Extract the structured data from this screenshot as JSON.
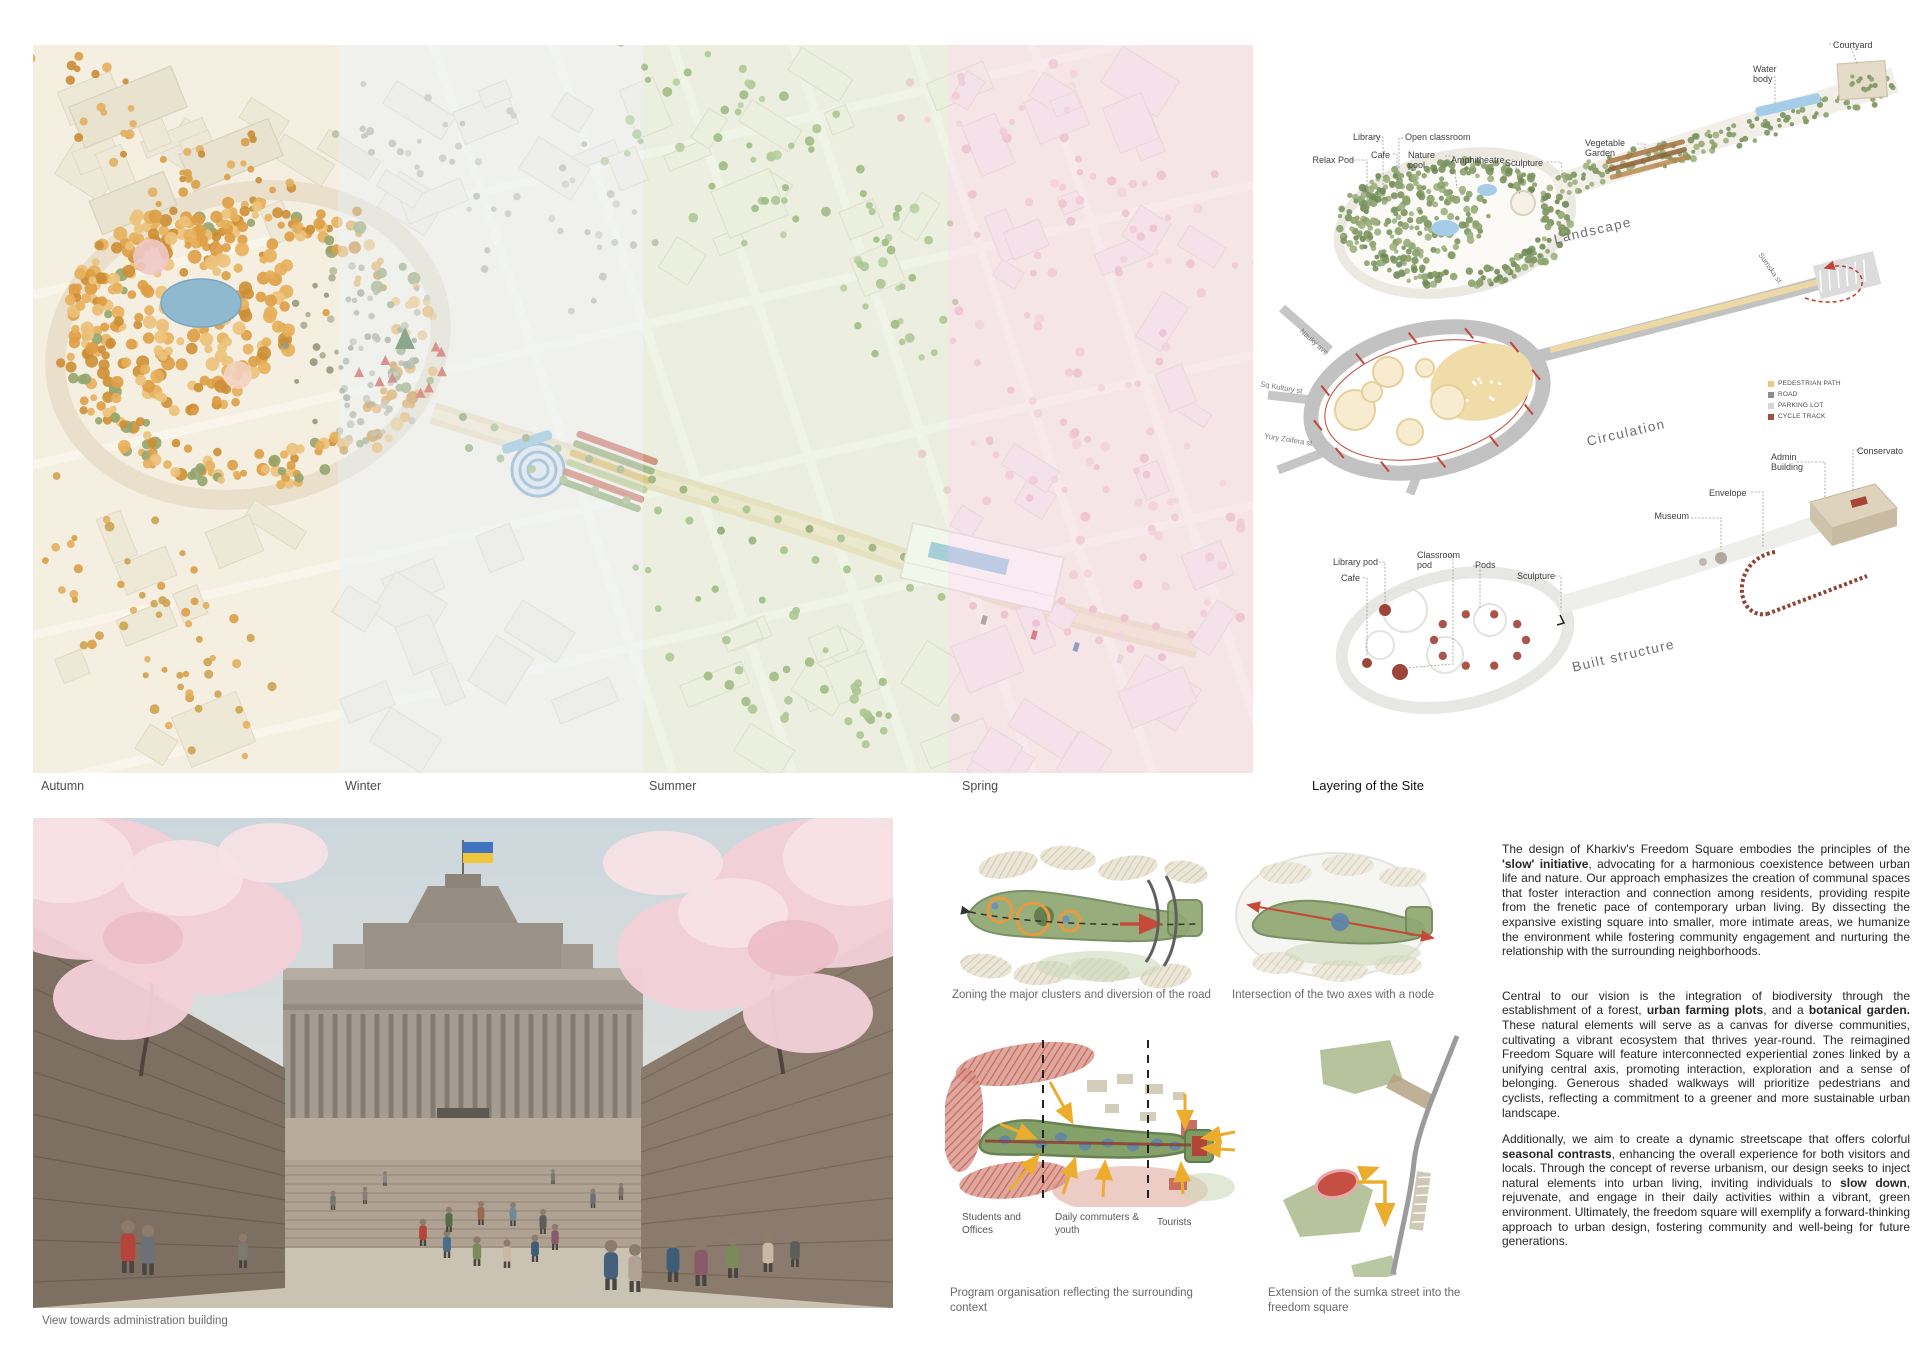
{
  "seasons": {
    "autumn": "Autumn",
    "winter": "Winter",
    "summer": "Summer",
    "spring": "Spring"
  },
  "layering": {
    "title": "Layering of the Site",
    "landscape": {
      "title": "Landscape",
      "labels": {
        "relax_pod": "Relax Pod",
        "library": "Library",
        "cafe": "Cafe",
        "open_classroom": "Open classroom",
        "nature_pool": "Nature pool",
        "amphitheatre": "Amphitheatre",
        "sculpture": "Sculpture",
        "vegetable_garden": "Vegetable Garden",
        "water_body": "Water body",
        "courtyard": "Courtyard"
      }
    },
    "circulation": {
      "title": "Circulation",
      "legend": [
        {
          "label": "PEDESTRIAN PATH",
          "color": "#eac97e"
        },
        {
          "label": "ROAD",
          "color": "#8d8d8d"
        },
        {
          "label": "PARKING LOT",
          "color": "#d6d6d6"
        },
        {
          "label": "CYCLE TRACK",
          "color": "#a14f44"
        }
      ],
      "streets": {
        "nauky": "Nauky ave",
        "kultury": "Sq Kultury st",
        "zoifera": "Yury Zoifera st",
        "sumska": "Sumska st"
      }
    },
    "built": {
      "title": "Built structure",
      "labels": {
        "library_pod": "Library pod",
        "cafe": "Cafe",
        "classroom_pod": "Classroom pod",
        "pods": "Pods",
        "sculpture": "Sculpture",
        "museum": "Museum",
        "envelope": "Envelope",
        "admin_building": "Admin Building",
        "conservatory": "Conservato"
      }
    }
  },
  "render_caption": "View towards administration building",
  "diagrams": {
    "zoning": {
      "caption": "Zoning the major clusters and diversion of the road"
    },
    "intersection": {
      "caption": "Intersection of the two axes with a node"
    },
    "program": {
      "caption": "Program organisation reflecting the surrounding context",
      "labels": {
        "students": "Students and Offices",
        "commuters": "Daily commuters & youth",
        "tourists": "Tourists"
      }
    },
    "extension": {
      "caption": "Extension of the sumka street into the freedom square"
    }
  },
  "narrative": {
    "paragraphs": [
      {
        "segments": [
          {
            "t": "The design of Kharkiv's Freedom Square embodies the principles of the ",
            "b": false
          },
          {
            "t": "'slow' initiative",
            "b": true
          },
          {
            "t": ", advocating for a harmonious coexistence between urban life and nature. Our approach emphasizes the creation of communal spaces that foster interaction and connection among residents, providing respite from the frenetic pace of contemporary urban living. By dissecting the expansive existing square into smaller, more intimate areas, we humanize the environment while fostering community engagement and nurturing the relationship with the surrounding neighborhoods.",
            "b": false
          }
        ]
      },
      {
        "segments": [
          {
            "t": "Central to our vision is the integration of biodiversity through the establishment of a forest, ",
            "b": false
          },
          {
            "t": "urban farming plots",
            "b": true
          },
          {
            "t": ", and a ",
            "b": false
          },
          {
            "t": "botanical garden.",
            "b": true
          },
          {
            "t": " These natural elements will serve as a canvas for diverse communities, cultivating a vibrant ecosystem that thrives year-round. The reimagined Freedom Square will feature interconnected experiential zones linked by a unifying central axis, promoting interaction, exploration and a sense of belonging. Generous shaded walkways will prioritize pedestrians and cyclists, reflecting a commitment to a greener and more sustainable urban landscape.",
            "b": false
          }
        ]
      },
      {
        "segments": [
          {
            "t": "Additionally, we aim to create a dynamic streetscape that offers colorful ",
            "b": false
          },
          {
            "t": "seasonal contrasts",
            "b": true
          },
          {
            "t": ", enhancing the overall experience for both visitors and locals. Through the concept of reverse urbanism, our design seeks to inject natural elements into urban living, inviting individuals to ",
            "b": false
          },
          {
            "t": "slow down",
            "b": true
          },
          {
            "t": ", rejuvenate, and engage in their daily activities within a vibrant, green environment. Ultimately, the freedom square will exemplify a forward-thinking approach to urban design, fostering community and well-being for future generations.",
            "b": false
          }
        ]
      }
    ]
  }
}
